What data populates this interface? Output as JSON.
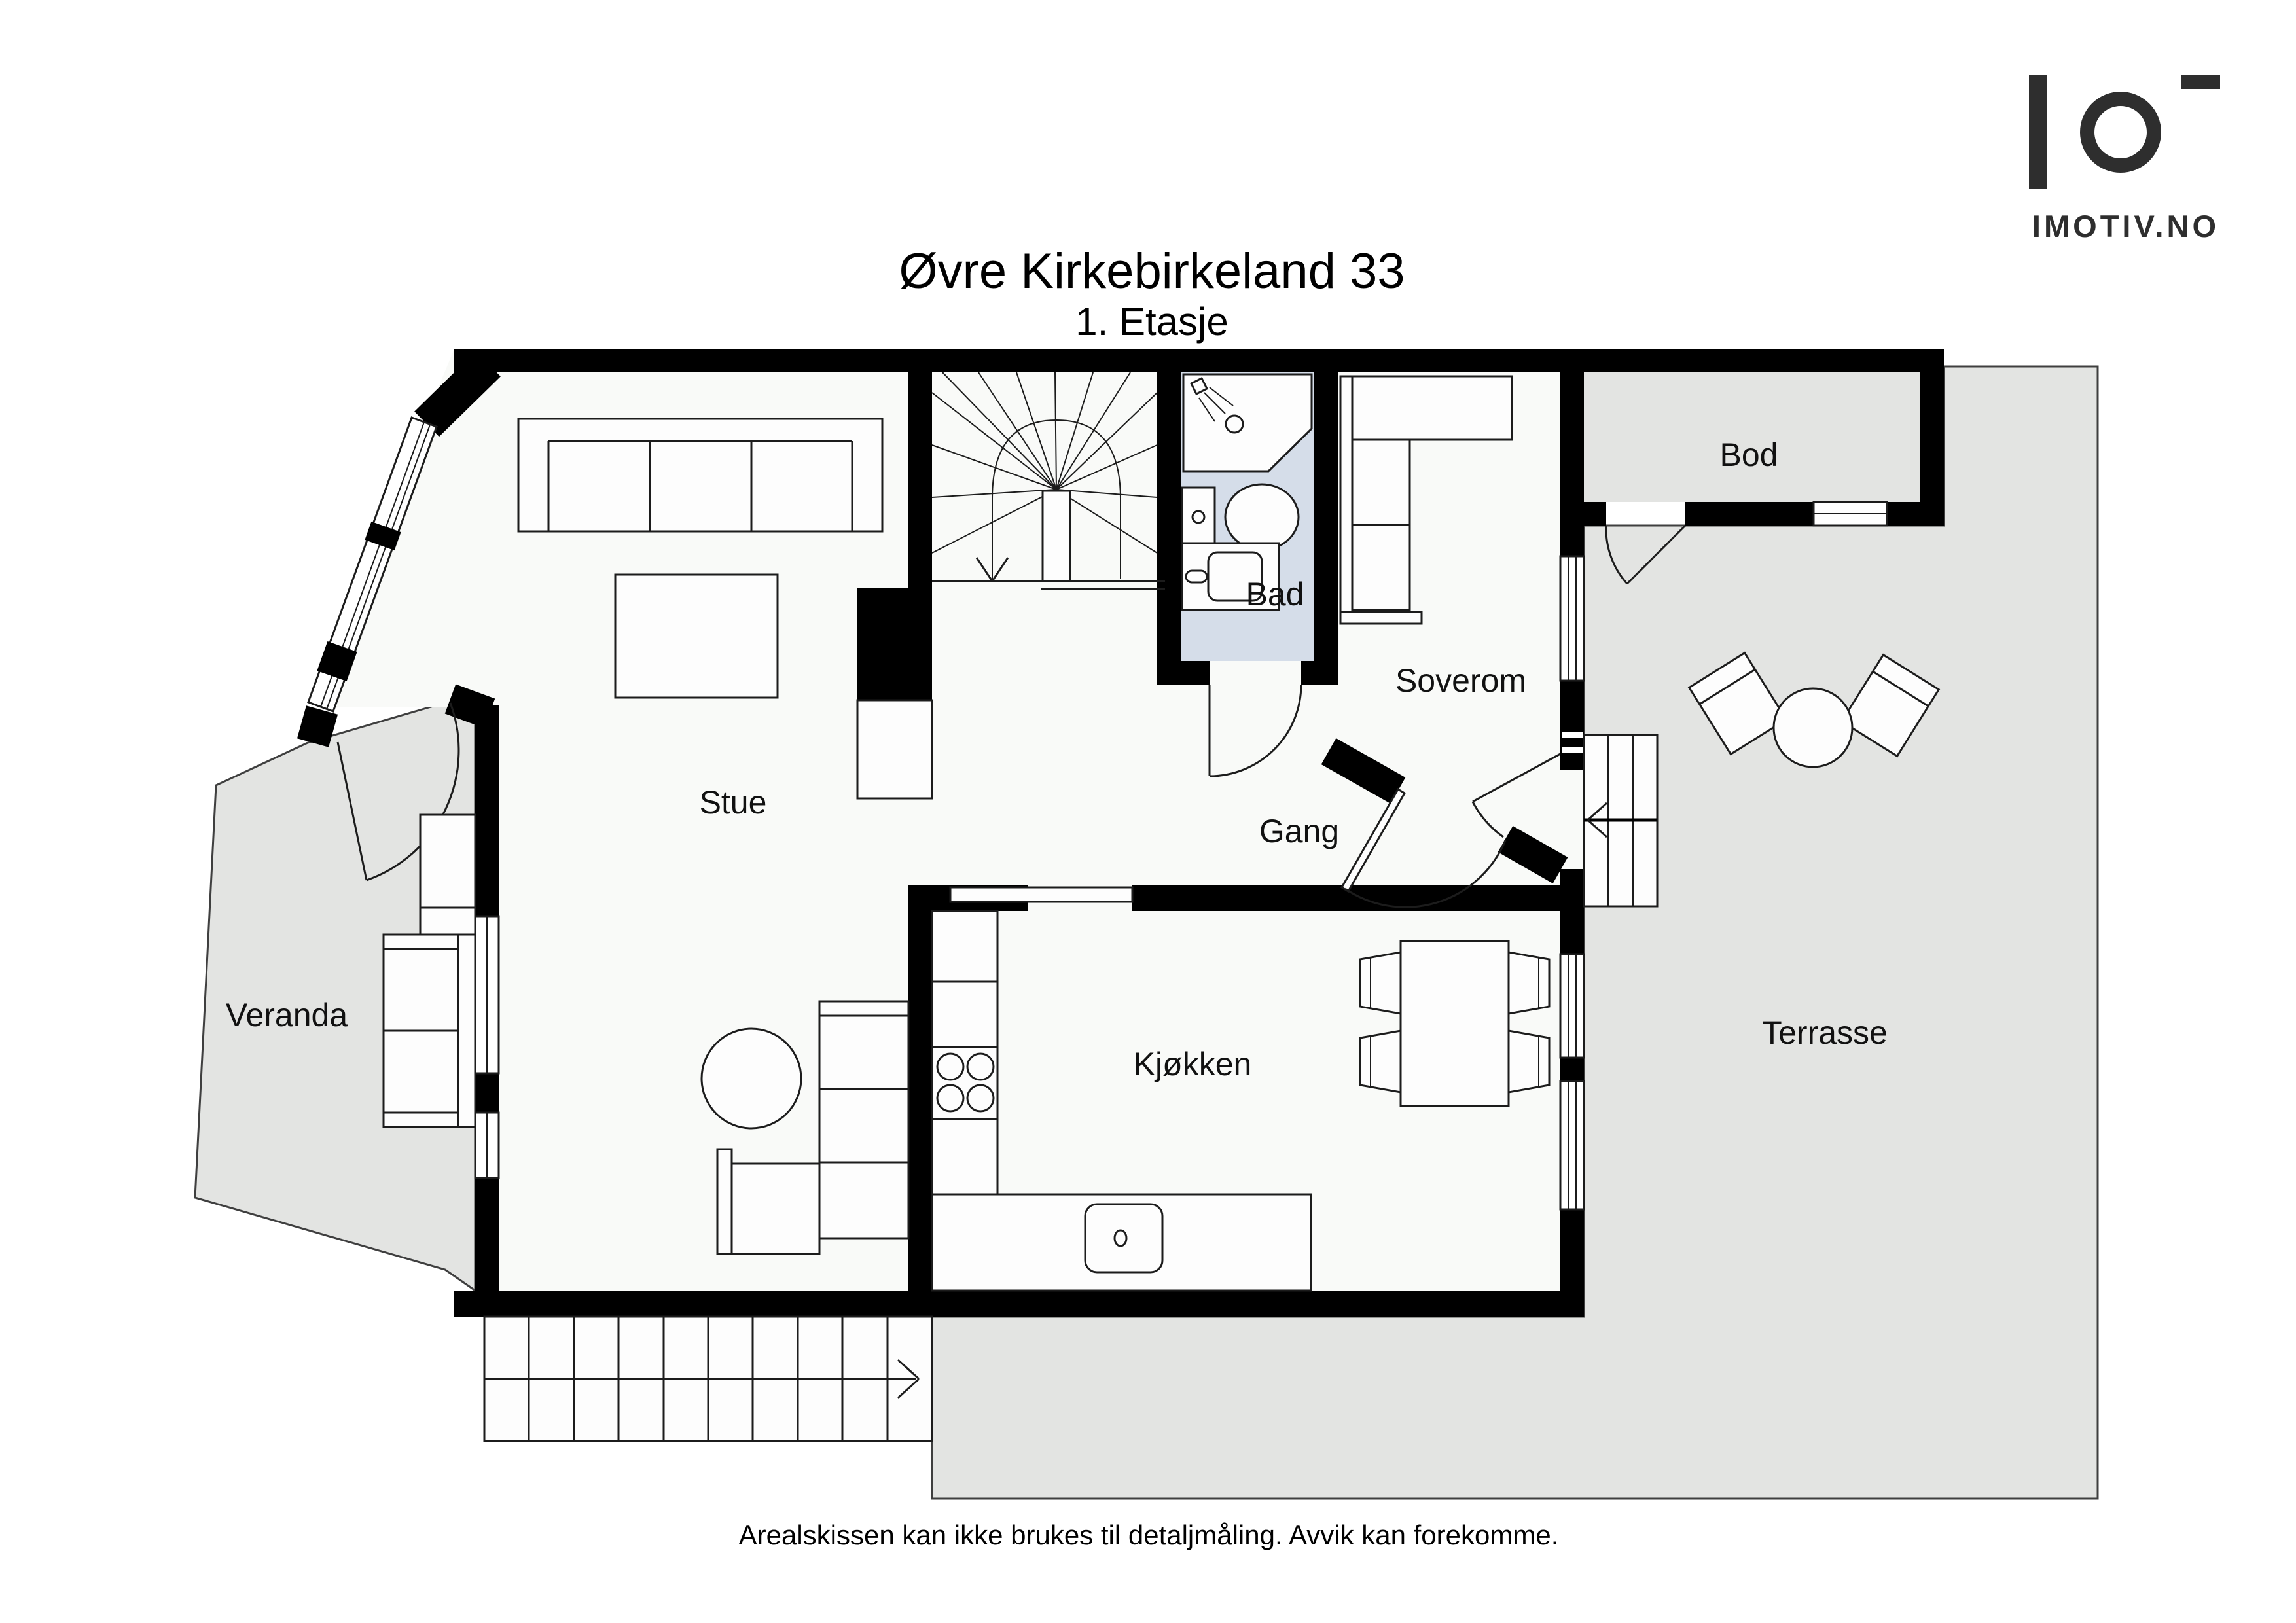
{
  "header": {
    "title": "Øvre Kirkebirkeland 33",
    "subtitle": "1. Etasje"
  },
  "logo": {
    "brand": "IMOTIV.NO"
  },
  "rooms": {
    "stue": "Stue",
    "veranda": "Veranda",
    "bad": "Bad",
    "soverom": "Soverom",
    "gang": "Gang",
    "kjokken": "Kjøkken",
    "bod": "Bod",
    "terrasse": "Terrasse"
  },
  "footer": {
    "disclaimer": "Arealskissen kan ikke brukes til detaljmåling. Avvik kan forekomme."
  },
  "colors": {
    "wall": "#000000",
    "outdoor_area": "#e3e4e2",
    "bathroom_floor": "#d5dde9",
    "interior_floor": "#f9faf8",
    "line": "#1c1c1c",
    "logo": "#2e2e2e"
  },
  "icons": {
    "stair_walk_direction": "arrow-down",
    "terrace_stair_direction": "arrow-right",
    "entry_stair_direction": "arrow-left",
    "shower_head": "spray-fan"
  }
}
